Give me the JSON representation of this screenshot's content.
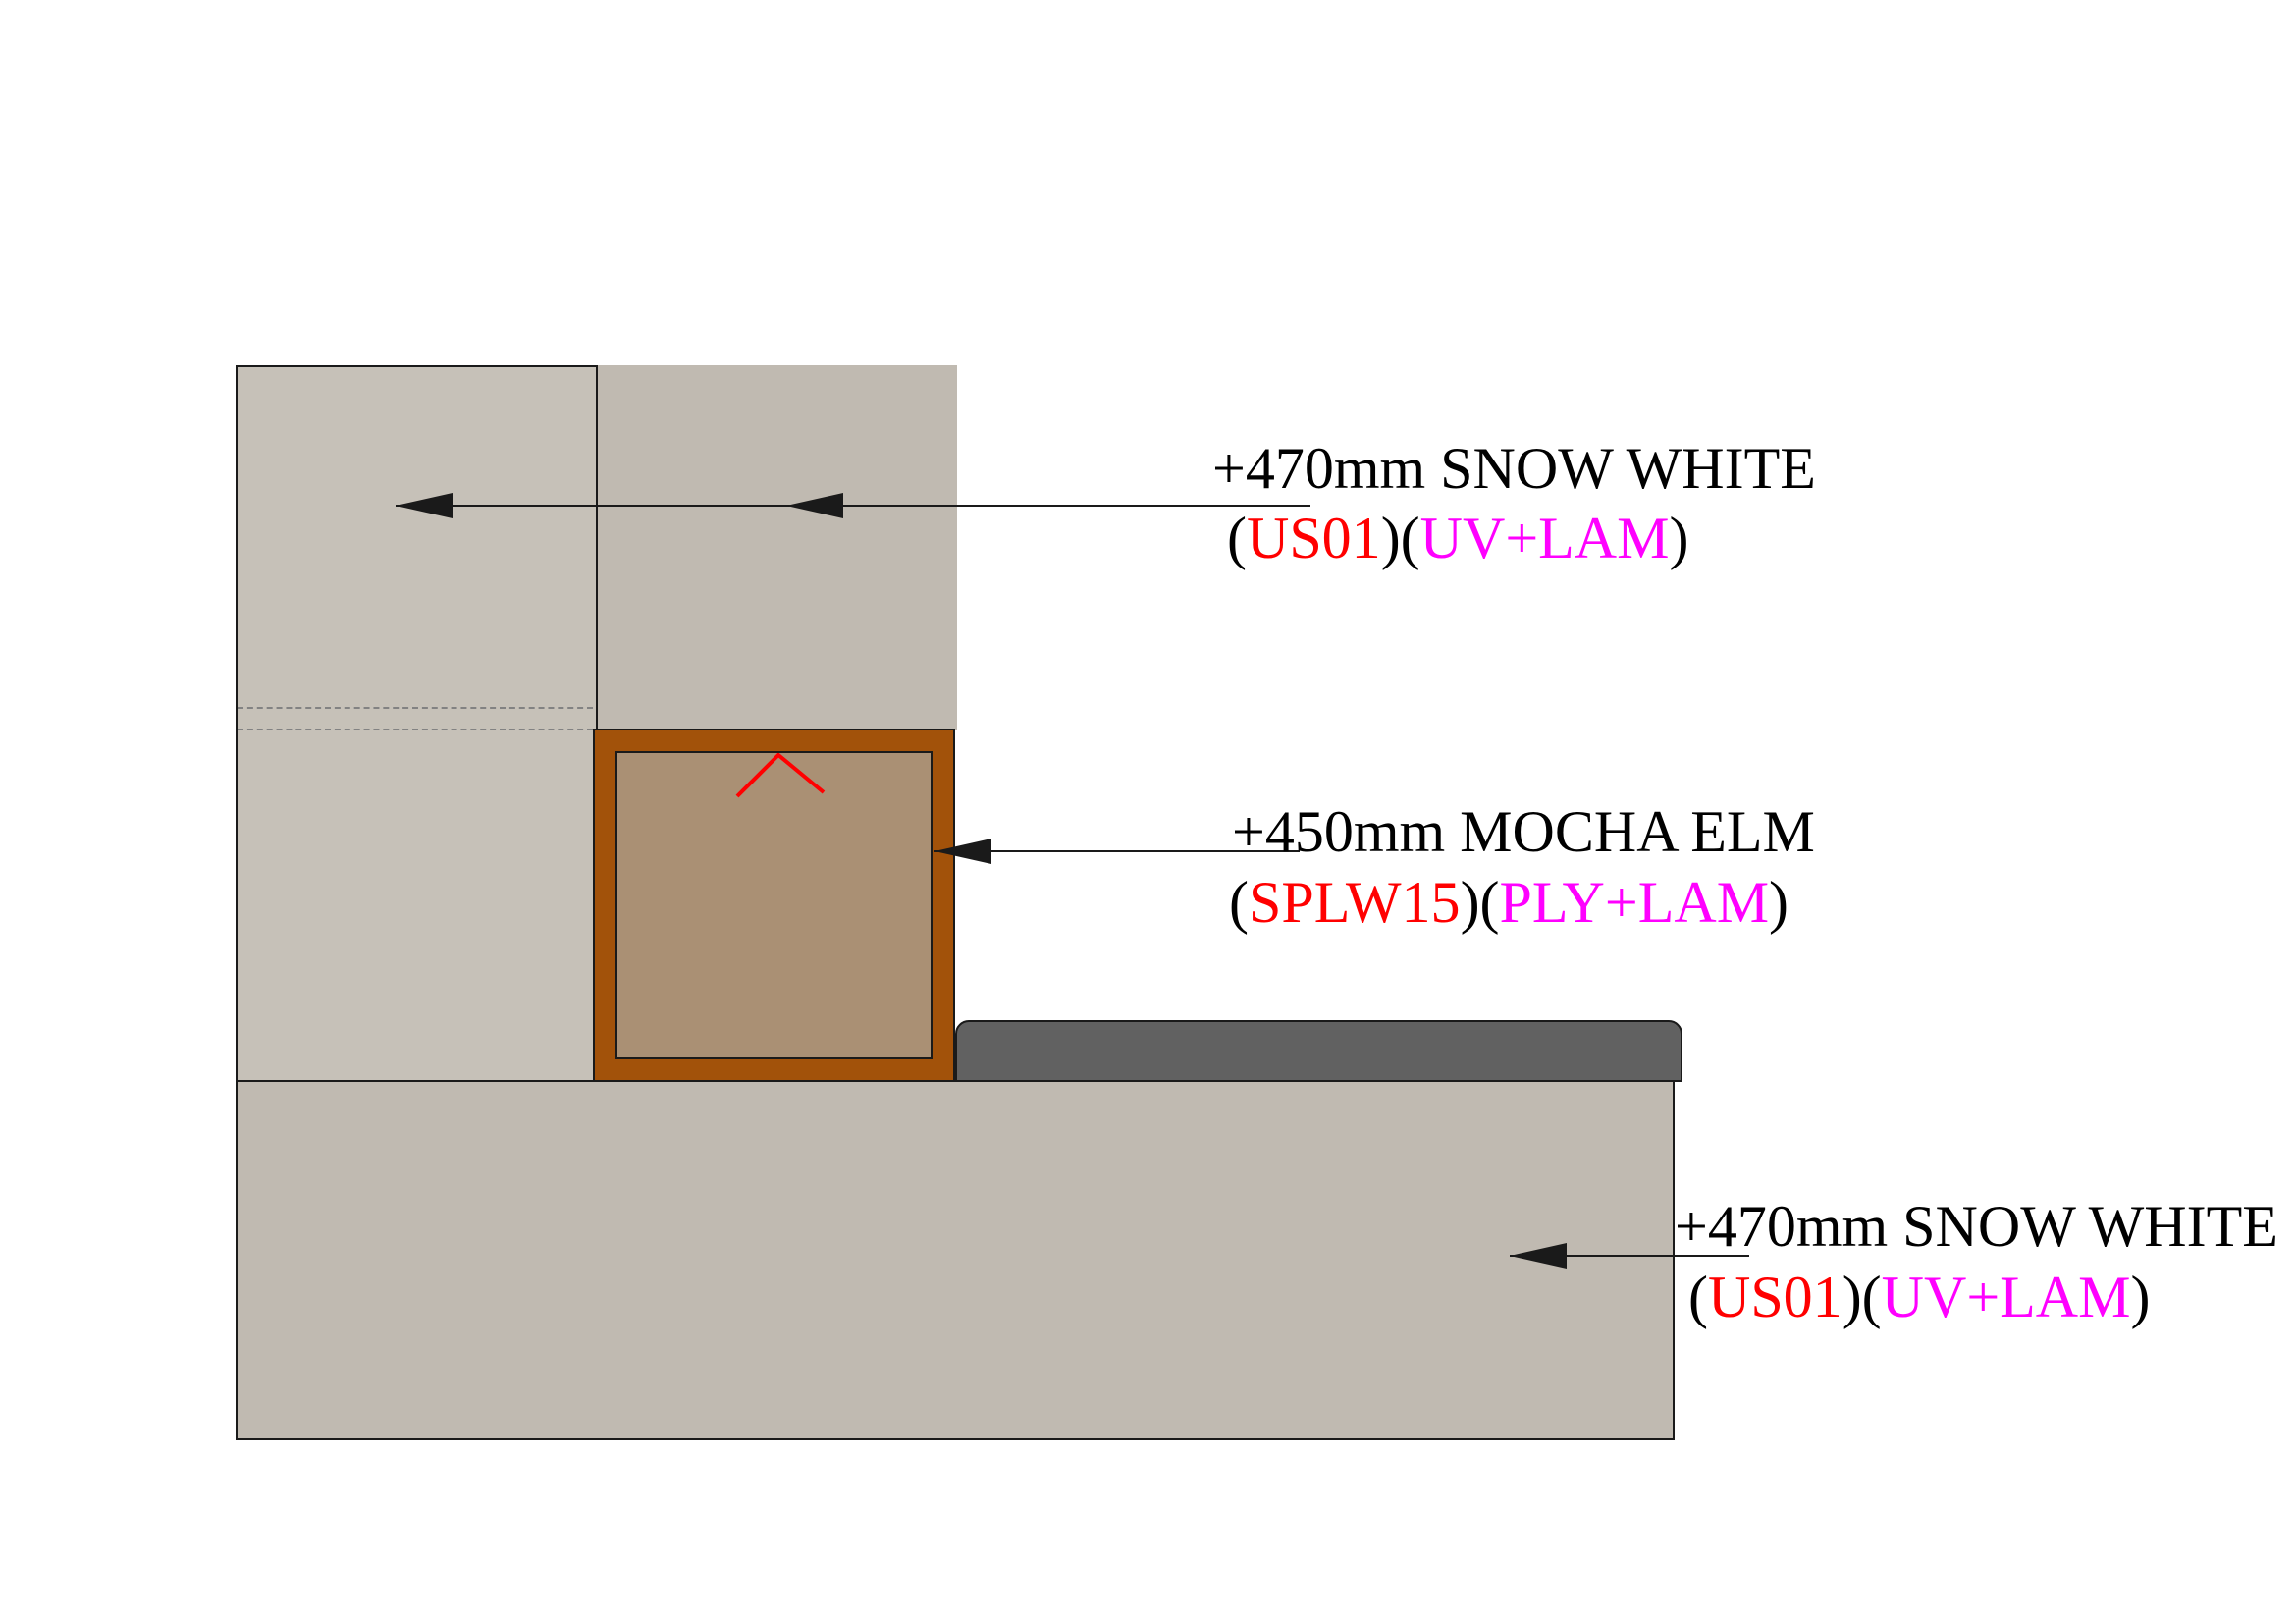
{
  "colors": {
    "cabinet_gray": "#c0bab1",
    "cabinet_gray_light": "#c6c1b8",
    "countertop_gray": "#616161",
    "frame_brown": "#a2520a",
    "panel_tan": "#aa9074",
    "line_black": "#1a1a1a",
    "dash_gray": "#828282",
    "accent_red": "#ff0000",
    "accent_magenta": "#ff00ff"
  },
  "annotations": {
    "upper": {
      "line1": "+470mm SNOW WHITE",
      "line2": {
        "open": "(",
        "code": "US01",
        "mid": ")(",
        "finish": "UV+LAM",
        "close": ")"
      }
    },
    "middle": {
      "line1": "+450mm MOCHA ELM",
      "line2": {
        "open": "(",
        "code": "SPLW15",
        "mid": ")(",
        "finish": "PLY+LAM",
        "close": ")"
      }
    },
    "lower": {
      "line1": "+470mm SNOW WHITE",
      "line2": {
        "open": "(",
        "code": "US01",
        "mid": ")(",
        "finish": "UV+LAM",
        "close": ")"
      }
    }
  }
}
